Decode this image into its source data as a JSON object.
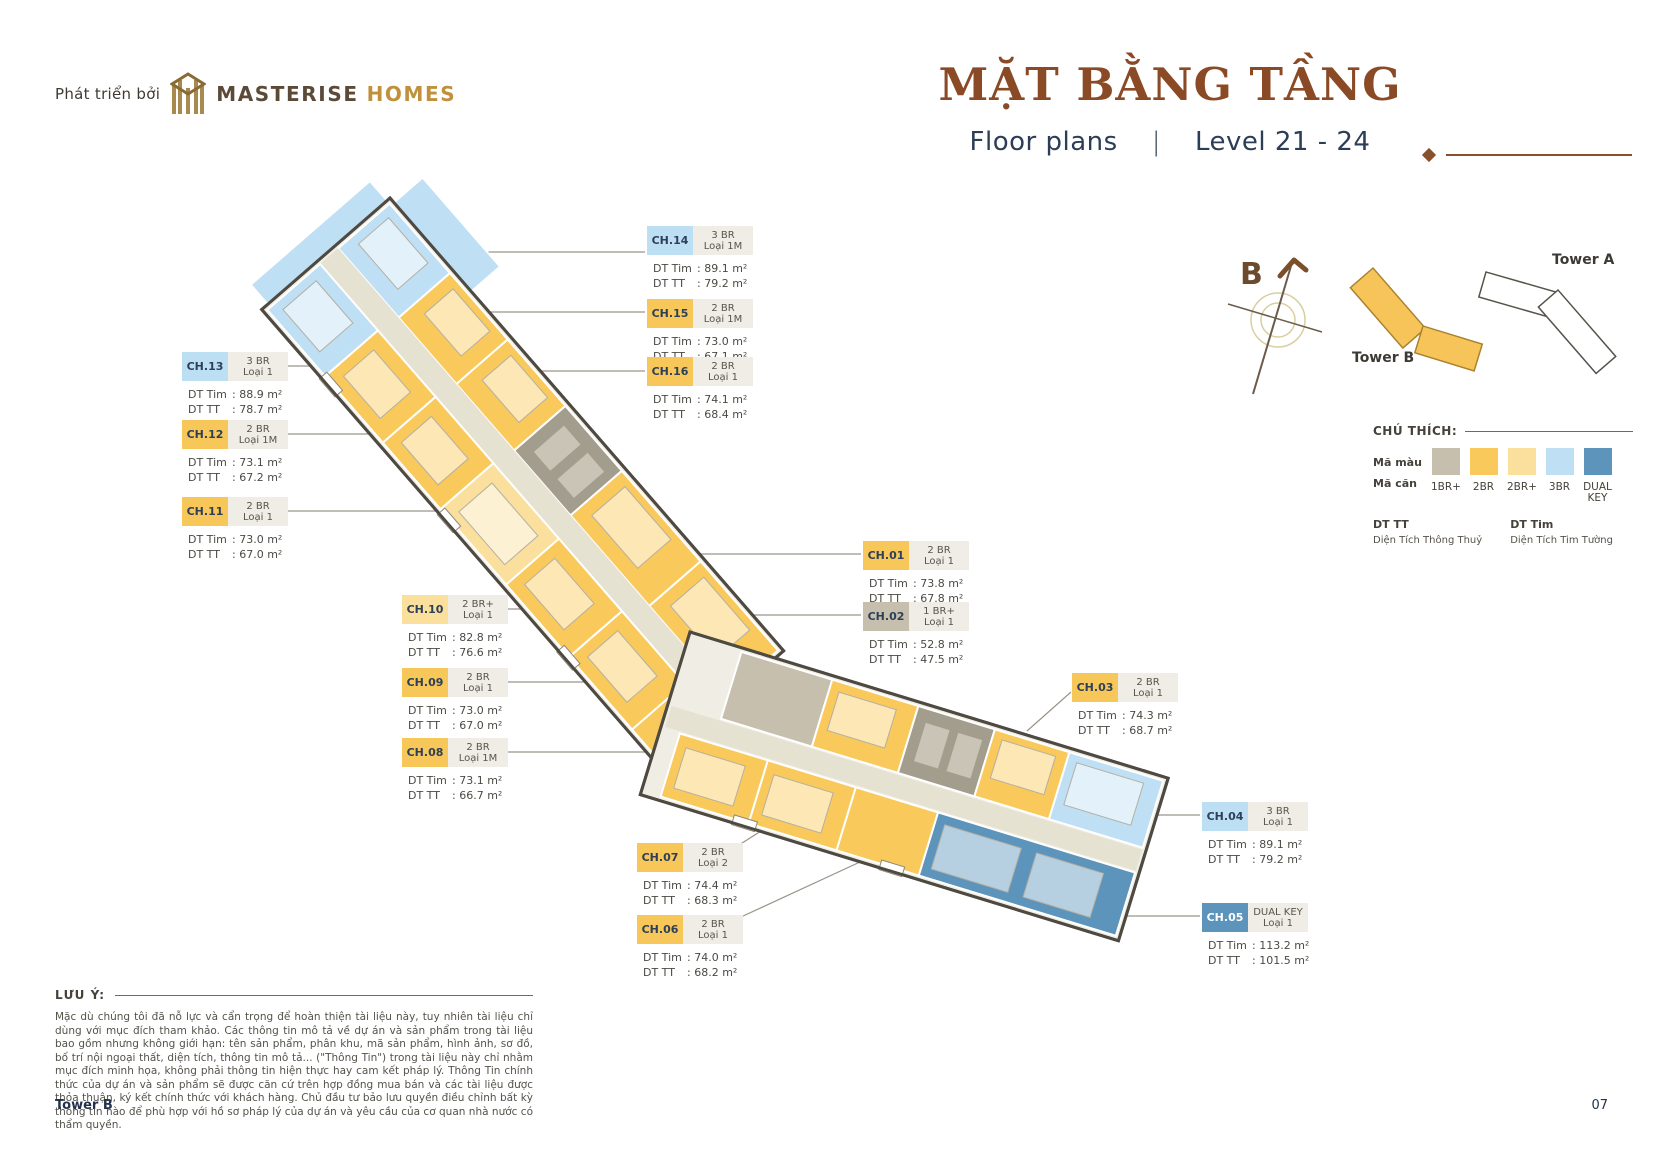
{
  "header": {
    "developer_prefix": "Phát triển bởi",
    "brand": "MASTERISE",
    "brand_suffix": "HOMES",
    "title": "MẶT BẰNG TẦNG",
    "subtitle_left": "Floor plans",
    "subtitle_divider": "|",
    "subtitle_right": "Level 21 - 24"
  },
  "compass": {
    "label": "B"
  },
  "towers": {
    "tower_b_label": "Tower B",
    "tower_a_label": "Tower A"
  },
  "legend": {
    "title": "CHÚ THÍCH:",
    "color_row_label": "Mã màu",
    "code_row_label": "Mã căn",
    "types": [
      {
        "label": "1BR+",
        "color": "#c6bfae"
      },
      {
        "label": "2BR",
        "color": "#f9c95c"
      },
      {
        "label": "2BR+",
        "color": "#fbdf9d"
      },
      {
        "label": "3BR",
        "color": "#bfe0f4"
      },
      {
        "label": "DUAL KEY",
        "color": "#5d94bc"
      }
    ],
    "dt_tt_abbr": "DT TT",
    "dt_tt_full": "Diện Tích Thông Thuỷ",
    "dt_tim_abbr": "DT Tim",
    "dt_tim_full": "Diện Tích Tim Tường"
  },
  "labels": {
    "dt_tim": "DT Tim",
    "dt_tt": "DT TT"
  },
  "units": [
    {
      "id": "CH.01",
      "type": "2 BR",
      "variant": "Loại 1",
      "dt_tim": "73.8 m²",
      "dt_tt": "67.8 m²",
      "category": "2BR"
    },
    {
      "id": "CH.02",
      "type": "1 BR+",
      "variant": "Loại 1",
      "dt_tim": "52.8 m²",
      "dt_tt": "47.5 m²",
      "category": "1BR+"
    },
    {
      "id": "CH.03",
      "type": "2 BR",
      "variant": "Loại 1",
      "dt_tim": "74.3 m²",
      "dt_tt": "68.7 m²",
      "category": "2BR"
    },
    {
      "id": "CH.04",
      "type": "3 BR",
      "variant": "Loại 1",
      "dt_tim": "89.1 m²",
      "dt_tt": "79.2 m²",
      "category": "3BR"
    },
    {
      "id": "CH.05",
      "type": "DUAL KEY",
      "variant": "Loại 1",
      "dt_tim": "113.2 m²",
      "dt_tt": "101.5 m²",
      "category": "DUAL KEY"
    },
    {
      "id": "CH.06",
      "type": "2 BR",
      "variant": "Loại 1",
      "dt_tim": "74.0 m²",
      "dt_tt": "68.2 m²",
      "category": "2BR"
    },
    {
      "id": "CH.07",
      "type": "2 BR",
      "variant": "Loại 2",
      "dt_tim": "74.4 m²",
      "dt_tt": "68.3 m²",
      "category": "2BR"
    },
    {
      "id": "CH.08",
      "type": "2 BR",
      "variant": "Loại 1M",
      "dt_tim": "73.1 m²",
      "dt_tt": "66.7 m²",
      "category": "2BR"
    },
    {
      "id": "CH.09",
      "type": "2 BR",
      "variant": "Loại 1",
      "dt_tim": "73.0 m²",
      "dt_tt": "67.0 m²",
      "category": "2BR"
    },
    {
      "id": "CH.10",
      "type": "2 BR+",
      "variant": "Loại 1",
      "dt_tim": "82.8 m²",
      "dt_tt": "76.6 m²",
      "category": "2BR+"
    },
    {
      "id": "CH.11",
      "type": "2 BR",
      "variant": "Loại 1",
      "dt_tim": "73.0 m²",
      "dt_tt": "67.0 m²",
      "category": "2BR"
    },
    {
      "id": "CH.12",
      "type": "2 BR",
      "variant": "Loại 1M",
      "dt_tim": "73.1 m²",
      "dt_tt": "67.2 m²",
      "category": "2BR"
    },
    {
      "id": "CH.13",
      "type": "3 BR",
      "variant": "Loại 1",
      "dt_tim": "88.9 m²",
      "dt_tt": "78.7 m²",
      "category": "3BR"
    },
    {
      "id": "CH.14",
      "type": "3 BR",
      "variant": "Loại 1M",
      "dt_tim": "89.1 m²",
      "dt_tt": "79.2 m²",
      "category": "3BR"
    },
    {
      "id": "CH.15",
      "type": "2 BR",
      "variant": "Loại 1M",
      "dt_tim": "73.0 m²",
      "dt_tt": "67.1 m²",
      "category": "2BR"
    },
    {
      "id": "CH.16",
      "type": "2 BR",
      "variant": "Loại 1",
      "dt_tim": "74.1 m²",
      "dt_tt": "68.4 m²",
      "category": "2BR"
    }
  ],
  "note": {
    "label": "LƯU Ý:",
    "text": "Mặc dù chúng tôi đã nỗ lực và cẩn trọng để hoàn thiện tài liệu này, tuy nhiên tài liệu chỉ dùng với mục đích tham khảo. Các thông tin mô tả về dự án và sản phẩm trong tài liệu bao gồm nhưng không giới hạn: tên sản phẩm, phân khu, mã sản phẩm, hình ảnh, sơ đồ, bố trí nội ngoại thất, diện tích, thông tin mô tả... (\"Thông Tin\") trong tài liệu này chỉ nhằm mục đích minh họa, không phải thông tin hiện thực hay cam kết pháp lý. Thông Tin chính thức của dự án và sản phẩm sẽ được căn cứ trên hợp đồng mua bán và các tài liệu được thỏa thuận, ký kết chính thức với khách hàng. Chủ đầu tư bảo lưu quyền điều chỉnh bất kỳ thông tin nào để phù hợp với hồ sơ pháp lý của dự án và yêu cầu của cơ quan nhà nước có thẩm quyền."
  },
  "footer": {
    "left": "Tower B",
    "right": "07"
  }
}
